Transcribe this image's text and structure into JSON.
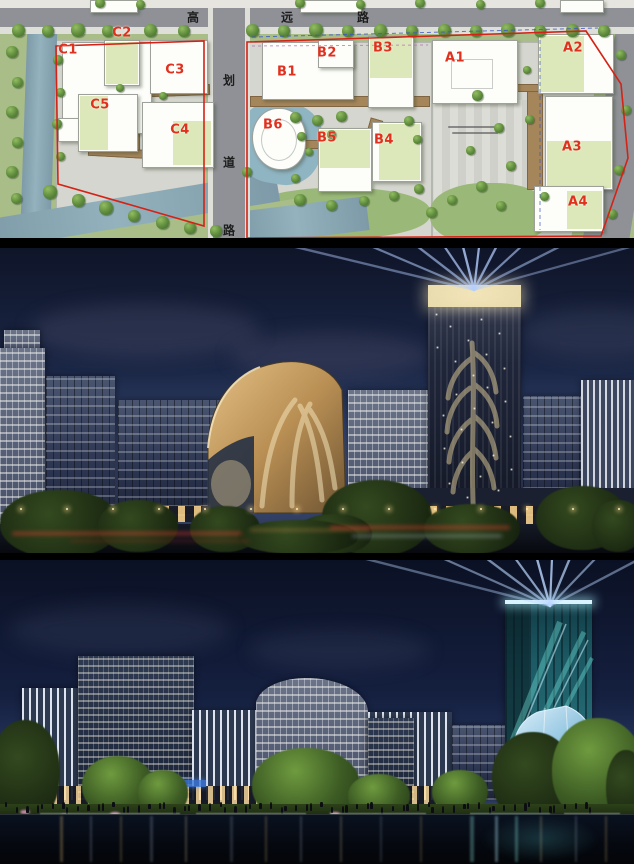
{
  "site_plan": {
    "horizontal_road_name": "高远路",
    "horizontal_road_chars": [
      {
        "ch": "高",
        "x": 193
      },
      {
        "ch": "远",
        "x": 287
      },
      {
        "ch": "路",
        "x": 363
      }
    ],
    "vertical_road_name": "划道路",
    "vertical_road_chars": [
      {
        "ch": "划",
        "y": 80
      },
      {
        "ch": "道",
        "y": 162
      },
      {
        "ch": "路",
        "y": 230
      }
    ],
    "building_labels": [
      {
        "id": "C1",
        "x": 68,
        "y": 50
      },
      {
        "id": "C2",
        "x": 122,
        "y": 33
      },
      {
        "id": "C3",
        "x": 175,
        "y": 70
      },
      {
        "id": "C5",
        "x": 100,
        "y": 105
      },
      {
        "id": "C4",
        "x": 180,
        "y": 130
      },
      {
        "id": "B1",
        "x": 287,
        "y": 72
      },
      {
        "id": "B2",
        "x": 327,
        "y": 53
      },
      {
        "id": "B3",
        "x": 383,
        "y": 48
      },
      {
        "id": "B6",
        "x": 273,
        "y": 125
      },
      {
        "id": "B5",
        "x": 327,
        "y": 138
      },
      {
        "id": "B4",
        "x": 384,
        "y": 140
      },
      {
        "id": "A1",
        "x": 455,
        "y": 58
      },
      {
        "id": "A2",
        "x": 573,
        "y": 48
      },
      {
        "id": "A3",
        "x": 572,
        "y": 147
      },
      {
        "id": "A4",
        "x": 578,
        "y": 202
      }
    ],
    "label_color": "#e0301e",
    "boundary_color": "#d42316",
    "inner_dash_color": "#3a56c8",
    "parcel_dash_color": "#b06ab0"
  },
  "renders": {
    "midrise_night": {
      "sky_top": "#0f1529",
      "sky_horizon": "#3a4a72",
      "beam_color": "#b4ceff",
      "tower_pattern_color": "#e3cf9a",
      "pavilion_gold": "#c49a5c"
    },
    "waterfront_night": {
      "sky_top": "#0b1124",
      "sky_horizon": "#2c3c66",
      "beam_color": "#bcd8ff",
      "tower_glass": "#2a6b74",
      "crystal_blue": "#9fd0ea"
    }
  }
}
